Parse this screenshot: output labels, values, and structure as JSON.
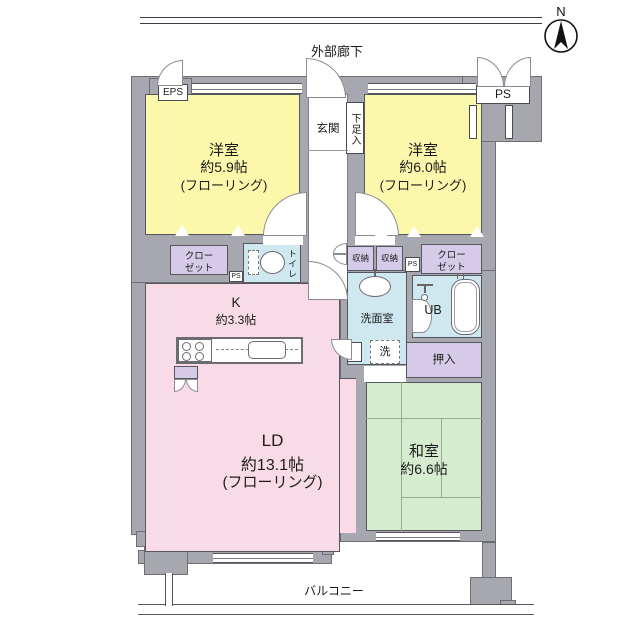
{
  "plan_title": "マンション間取り図",
  "compass": {
    "label": "N"
  },
  "corridor": {
    "label": "外部廊下"
  },
  "balcony": {
    "label": "バルコニー"
  },
  "shafts": {
    "eps": "EPS",
    "ps": "PS",
    "ps_small_left": "PS",
    "ps_small_right": "PS"
  },
  "rooms": {
    "bedroom_left": {
      "name": "洋室",
      "size": "約5.9帖",
      "note": "(フローリング)"
    },
    "bedroom_right": {
      "name": "洋室",
      "size": "約6.0帖",
      "note": "(フローリング)"
    },
    "entrance": {
      "name": "玄関"
    },
    "shoe_cabinet": {
      "name": "下足入"
    },
    "closet_left": {
      "line1": "クロー",
      "line2": "ゼット"
    },
    "closet_right": {
      "line1": "クロー",
      "line2": "ゼット"
    },
    "toilet": {
      "name": "トイレ"
    },
    "storage_a": {
      "name": "収納"
    },
    "storage_b": {
      "name": "収納"
    },
    "washroom": {
      "name": "洗面室"
    },
    "washer": {
      "name": "洗"
    },
    "bath": {
      "name": "UB"
    },
    "oshiire": {
      "name": "押入"
    },
    "kitchen": {
      "name": "K",
      "size": "約3.3帖"
    },
    "living": {
      "name": "LD",
      "size": "約13.1帖",
      "note": "(フローリング)"
    },
    "japanese_room": {
      "name": "和室",
      "size": "約6.6帖"
    }
  },
  "colors": {
    "wall": "#a7a7b0",
    "bedroom_fill": "#fcf8ab",
    "living_fill": "#f9dbe7",
    "closet_fill": "#d5cbe8",
    "wet_area_fill": "#cfe7ef",
    "tatami_fill": "#d5eccf"
  }
}
